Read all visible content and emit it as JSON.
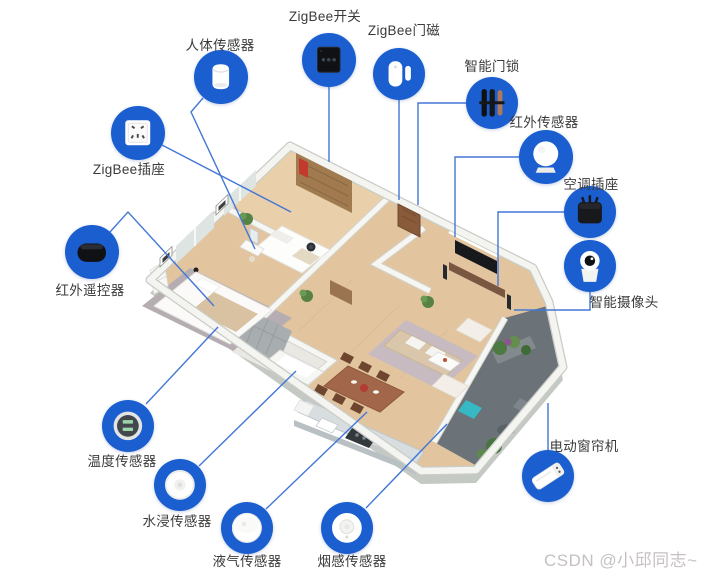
{
  "colors": {
    "accent_blue": "#1a5ed0",
    "line_blue": "#4377d6",
    "label_text": "#3b3b3b",
    "watermark_gray": "#c6c1c1",
    "background": "#ffffff"
  },
  "watermark": {
    "text": "CSDN @小邱同志~"
  },
  "diagram": {
    "devices": [
      {
        "id": "human-body-sensor",
        "label": "人体传感器",
        "icon": "body-sensor",
        "circle": {
          "cx": 221,
          "cy": 77,
          "r": 27
        },
        "label_pos": {
          "x": 220,
          "y": 44
        },
        "line": [
          [
            203,
            98
          ],
          [
            191,
            112
          ],
          [
            255,
            249
          ]
        ]
      },
      {
        "id": "zigbee-switch",
        "label": "ZigBee开关",
        "icon": "wall-switch",
        "circle": {
          "cx": 329,
          "cy": 60,
          "r": 27
        },
        "label_pos": {
          "x": 325,
          "y": 15
        },
        "line": [
          [
            329,
            87
          ],
          [
            329,
            162
          ]
        ]
      },
      {
        "id": "zigbee-door-magnet",
        "label": "ZigBee门磁",
        "icon": "door-magnet",
        "circle": {
          "cx": 399,
          "cy": 74,
          "r": 26
        },
        "label_pos": {
          "x": 404,
          "y": 29
        },
        "line": [
          [
            399,
            100
          ],
          [
            399,
            200
          ]
        ]
      },
      {
        "id": "smart-door-lock",
        "label": "智能门锁",
        "icon": "door-lock",
        "circle": {
          "cx": 492,
          "cy": 103,
          "r": 26
        },
        "label_pos": {
          "x": 492,
          "y": 65
        },
        "line": [
          [
            466,
            103
          ],
          [
            418,
            103
          ],
          [
            418,
            205
          ]
        ]
      },
      {
        "id": "infrared-sensor",
        "label": "红外传感器",
        "icon": "infrared-sensor",
        "circle": {
          "cx": 546,
          "cy": 157,
          "r": 27
        },
        "label_pos": {
          "x": 544,
          "y": 121
        },
        "line": [
          [
            519,
            157
          ],
          [
            455,
            157
          ],
          [
            455,
            237
          ]
        ]
      },
      {
        "id": "ac-socket",
        "label": "空调插座",
        "icon": "power-plug",
        "circle": {
          "cx": 590,
          "cy": 212,
          "r": 26
        },
        "label_pos": {
          "x": 591,
          "y": 183
        },
        "line": [
          [
            564,
            212
          ],
          [
            498,
            212
          ],
          [
            498,
            286
          ]
        ]
      },
      {
        "id": "smart-camera",
        "label": "智能摄像头",
        "icon": "camera",
        "circle": {
          "cx": 590,
          "cy": 266,
          "r": 26
        },
        "label_pos": {
          "x": 624,
          "y": 301
        },
        "line": [
          [
            590,
            292
          ],
          [
            590,
            310
          ],
          [
            514,
            310
          ]
        ]
      },
      {
        "id": "zigbee-socket",
        "label": "ZigBee插座",
        "icon": "wall-socket",
        "circle": {
          "cx": 138,
          "cy": 133,
          "r": 27
        },
        "label_pos": {
          "x": 129,
          "y": 168
        },
        "line": [
          [
            162,
            145
          ],
          [
            291,
            212
          ]
        ]
      },
      {
        "id": "ir-remote",
        "label": "红外遥控器",
        "icon": "remote",
        "circle": {
          "cx": 92,
          "cy": 252,
          "r": 27
        },
        "label_pos": {
          "x": 90,
          "y": 289
        },
        "line": [
          [
            110,
            232
          ],
          [
            128,
            212
          ],
          [
            214,
            306
          ]
        ]
      },
      {
        "id": "temperature-sensor",
        "label": "温度传感器",
        "icon": "thermometer",
        "circle": {
          "cx": 128,
          "cy": 426,
          "r": 26
        },
        "label_pos": {
          "x": 122,
          "y": 460
        },
        "line": [
          [
            146,
            404
          ],
          [
            218,
            327
          ]
        ]
      },
      {
        "id": "water-leak-sensor",
        "label": "水浸传感器",
        "icon": "water-sensor",
        "circle": {
          "cx": 180,
          "cy": 485,
          "r": 26
        },
        "label_pos": {
          "x": 177,
          "y": 520
        },
        "line": [
          [
            199,
            466
          ],
          [
            296,
            371
          ]
        ]
      },
      {
        "id": "gas-sensor",
        "label": "液气传感器",
        "icon": "gas-sensor",
        "circle": {
          "cx": 247,
          "cy": 528,
          "r": 26
        },
        "label_pos": {
          "x": 247,
          "y": 560
        },
        "line": [
          [
            266,
            509
          ],
          [
            367,
            412
          ]
        ]
      },
      {
        "id": "smoke-sensor",
        "label": "烟感传感器",
        "icon": "smoke-detector",
        "circle": {
          "cx": 347,
          "cy": 528,
          "r": 26
        },
        "label_pos": {
          "x": 352,
          "y": 560
        },
        "line": [
          [
            366,
            508
          ],
          [
            447,
            424
          ]
        ]
      },
      {
        "id": "curtain-motor",
        "label": "电动窗帘机",
        "icon": "curtain-motor",
        "circle": {
          "cx": 548,
          "cy": 476,
          "r": 26
        },
        "label_pos": {
          "x": 584,
          "y": 445
        },
        "line": [
          [
            548,
            450
          ],
          [
            548,
            403
          ]
        ]
      }
    ]
  }
}
